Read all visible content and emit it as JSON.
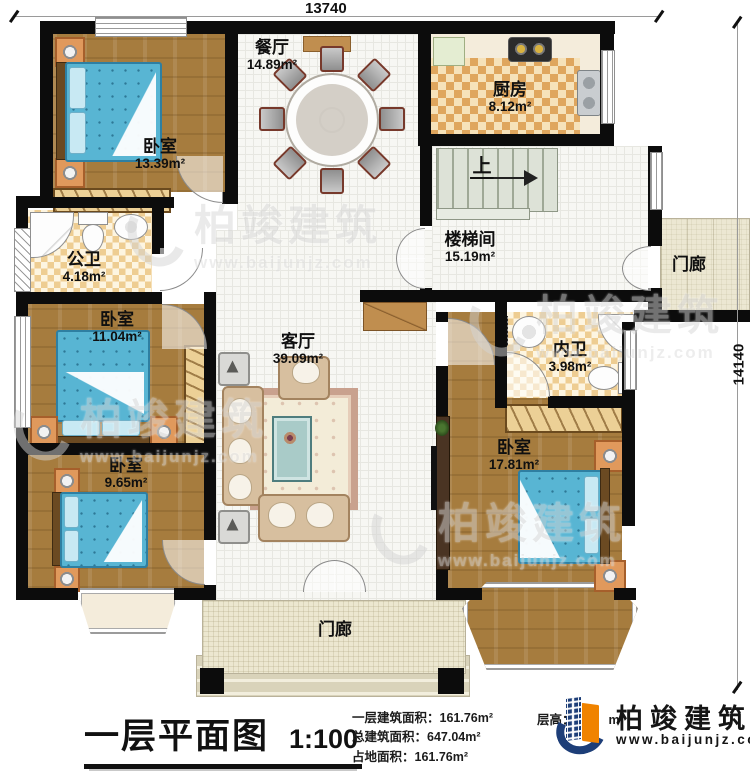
{
  "dims": {
    "top": "13740",
    "right": "14140"
  },
  "rooms": [
    {
      "id": "bedroom-top-left",
      "name": "卧室",
      "area": "13.39m²"
    },
    {
      "id": "dining",
      "name": "餐厅",
      "area": "14.89m²"
    },
    {
      "id": "kitchen",
      "name": "厨房",
      "area": "8.12m²"
    },
    {
      "id": "stairwell",
      "name": "楼梯间",
      "area": "15.19m²"
    },
    {
      "id": "porch-right",
      "name": "门廊"
    },
    {
      "id": "bath-public",
      "name": "公卫",
      "area": "4.18m²"
    },
    {
      "id": "bedroom-mid-left",
      "name": "卧室",
      "area": "11.04m²"
    },
    {
      "id": "living",
      "name": "客厅",
      "area": "39.09m²"
    },
    {
      "id": "bath-ensuite",
      "name": "内卫",
      "area": "3.98m²"
    },
    {
      "id": "bedroom-bot-left",
      "name": "卧室",
      "area": "9.65m²"
    },
    {
      "id": "bedroom-bot-right",
      "name": "卧室",
      "area": "17.81m²"
    },
    {
      "id": "porch-bottom",
      "name": "门廊"
    }
  ],
  "labels": {
    "up": "上"
  },
  "titlebar": {
    "title": "一层平面图",
    "scale": "1:100",
    "stats": [
      "一层建筑面积：161.76m²",
      "总建筑面积：647.04m²",
      "占地面积：161.76m²"
    ],
    "floor_height_label": "层高：",
    "floor_height_suffix": "m"
  },
  "brand": {
    "name": "柏竣建筑",
    "url": "www.baijunjz.com"
  },
  "watermark": {
    "name": "柏竣建筑",
    "url": "www.baijunjz.com"
  }
}
